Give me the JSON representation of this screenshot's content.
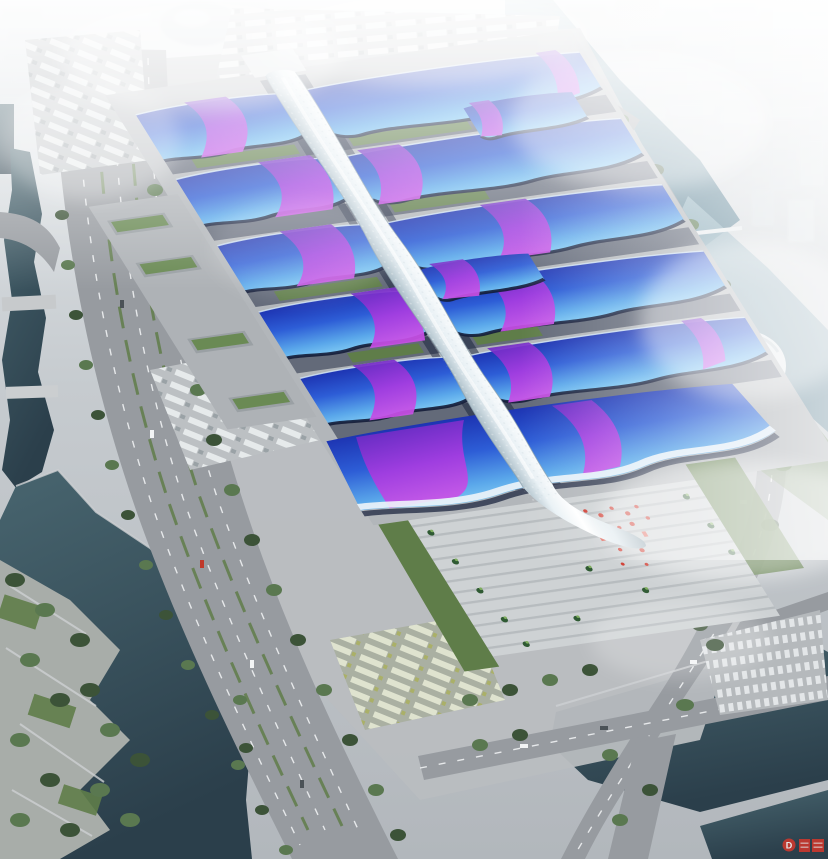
{
  "scene": {
    "type": "architectural-aerial-rendering",
    "description": "Bird's-eye rendering of a riverside exhibition and convention center: two columns of wave-edged exhibition halls with blue roofs and sweeping purple ribbon graphics flank a white serpentine central concourse spine that ends in a grand entrance hall and a striped forecourt plaza with palm trees and a red art installation. The site is bordered by tree-lined boulevards, truck and bus parking lots, canals, a dark river with an angular waterfront park, and a hazy white city skyline fading into fog.",
    "complex": {
      "hall_rows": 5,
      "halls_per_row": 2,
      "extra_structures": [
        "grand entrance hall",
        "central spine concourse",
        "forecourt plaza"
      ]
    },
    "watermark": {
      "letter": "D"
    }
  },
  "theme": {
    "fog": "#f4f7f8",
    "city": "#e2e7ea",
    "ground": "#b9bdc0",
    "road": "#979ba0",
    "road_light": "#c2c5c8",
    "lane": "#eef1f2",
    "median_green": "#5f7d49",
    "tree_dark": "#3c5338",
    "tree_mid": "#5a7850",
    "water_dark": "#2b3f4b",
    "water_mid": "#48656f",
    "water_light": "#85a8b6",
    "roof_deep": "#1b2fae",
    "roof_mid": "#2d5dd6",
    "roof_light": "#5aa7ea",
    "roof_pale": "#79c4f2",
    "ribbon_deep": "#6c2bc4",
    "ribbon_bright": "#c94fe6",
    "spine_white": "#f3f8fa",
    "spine_shade": "#a9bcc6",
    "shadow_navy": "#141d38",
    "plaza": "#ced2d4",
    "lawn": "#57734b",
    "red_accent": "#cf382d"
  }
}
